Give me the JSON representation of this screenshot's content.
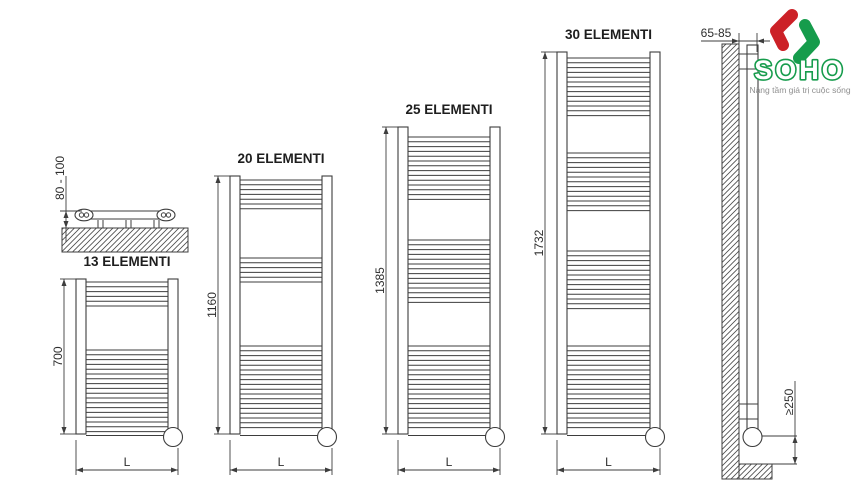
{
  "radiators": [
    {
      "label": "13 ELEMENTI",
      "height_label": "700",
      "width_label": "L"
    },
    {
      "label": "20 ELEMENTI",
      "height_label": "1160",
      "width_label": "L"
    },
    {
      "label": "25 ELEMENTI",
      "height_label": "1385",
      "width_label": "L"
    },
    {
      "label": "30 ELEMENTI",
      "height_label": "1732",
      "width_label": "L"
    }
  ],
  "top_view": {
    "dimension_label": "80 - 100"
  },
  "side_view": {
    "wall_distance_label": "65-85",
    "floor_clearance_label": "≥250"
  },
  "logo": {
    "name": "SOHO",
    "tagline": "Nâng tầm giá trị cuộc sống"
  },
  "colors": {
    "line": "#3d3d3d",
    "logo_green": "#169c4c",
    "logo_red": "#cc2127",
    "tagline_gray": "#8f8f8f"
  }
}
